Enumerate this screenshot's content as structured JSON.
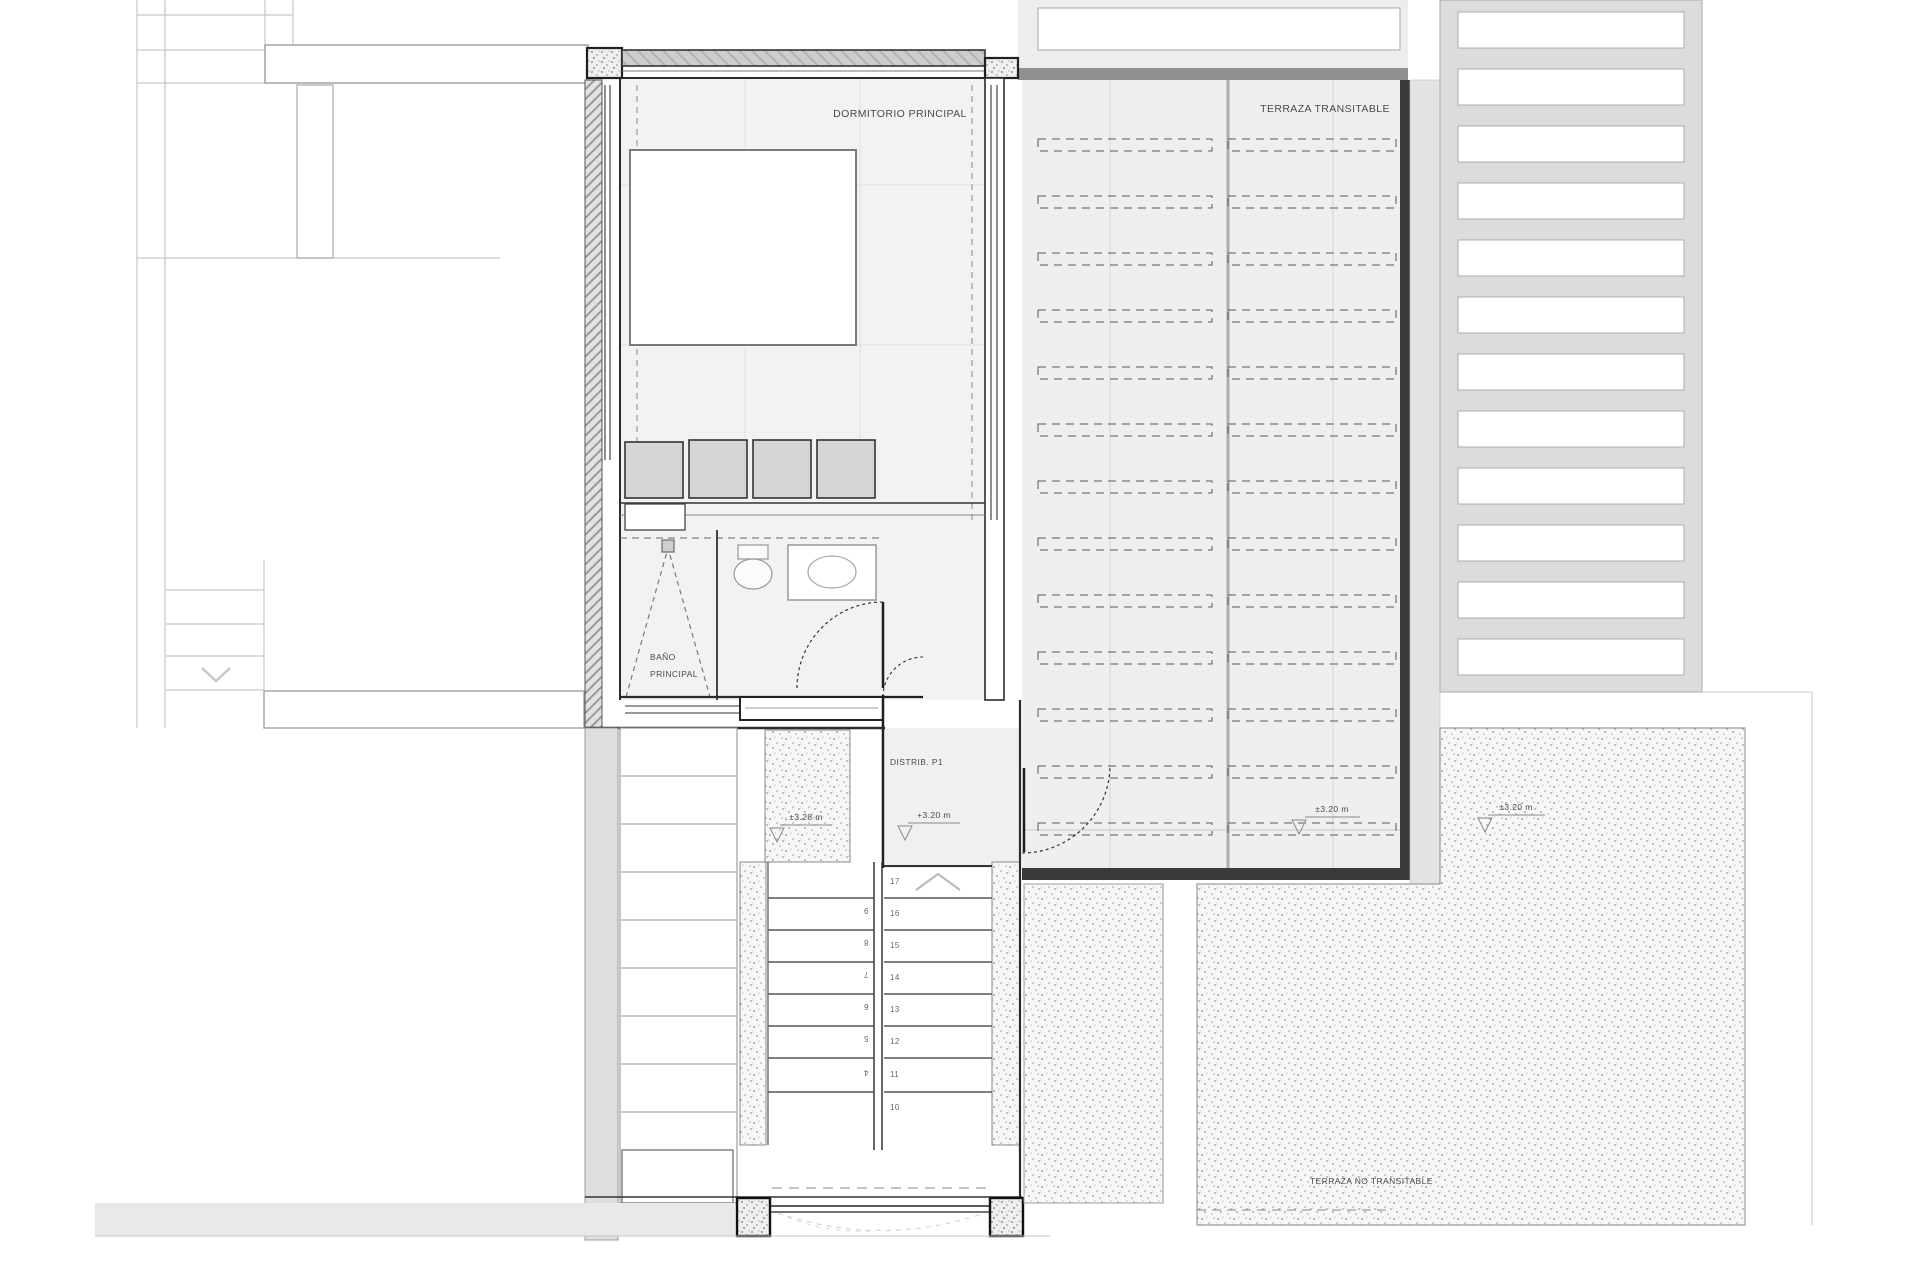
{
  "drawing": {
    "rooms": {
      "bedroom": "DORMITORIO PRINCIPAL",
      "terrace_walkable": "TERRAZA TRANSITABLE",
      "terrace_non_walkable": "TERRAZA NO TRANSITABLE",
      "bathroom_line1": "BAÑO",
      "bathroom_line2": "PRINCIPAL",
      "hall": "DISTRIB. P1"
    },
    "levels": {
      "hall": "+3.20 m",
      "stair_landing": "±3.28 m",
      "terrace_walkable": "±3.20 m",
      "terrace_non_walkable": "±3.20 m"
    },
    "stairs": {
      "up_flight": [
        "17",
        "16",
        "15",
        "14",
        "13",
        "12",
        "11",
        "10"
      ],
      "down_flight": [
        "9",
        "8",
        "7",
        "6",
        "5",
        "4"
      ]
    },
    "colors": {
      "line_dark": "#2b2b2b",
      "line_faint": "#c6c6c6",
      "floor": "#f1f1f1",
      "wall_gray": "#cccccc",
      "terrace_edge_dark": "#3a3a3a",
      "terrace_floor": "#efefef",
      "party_strip": "#dedede",
      "louver_band": "#dcdcdc"
    }
  }
}
